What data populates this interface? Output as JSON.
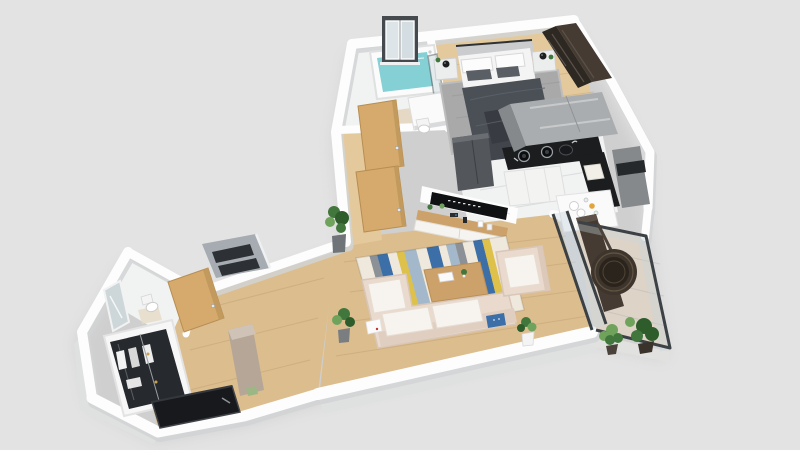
{
  "meta": {
    "view": "3d-isometric-apartment-floor-plan-render",
    "background": "#e3e3e3",
    "visible_text": ""
  },
  "palette": {
    "background": "#e3e3e3",
    "wall": "#fdfdfd",
    "wall_shade": "#d2d4d5",
    "wall_face": "#dfe0e0",
    "floor_wood": "#dcbd8e",
    "floor_wood_light": "#e4c99c",
    "floor_marble": "#f1f2f2",
    "floor_balcony": "#ddd3c6",
    "door_oak": "#d5aa6c",
    "door_oak_edge": "#b78d52",
    "rug_gray": "#a9a9a9",
    "rug_cream": "#efe9dd",
    "stripe_blue": "#3c6fa8",
    "stripe_lightblue": "#a3b9cb",
    "stripe_yellow": "#ddc14a",
    "stripe_gray": "#8b9196",
    "sofa_beige": "#e9dacd",
    "sofa_back": "#e0cfc1",
    "cushion_white": "#f7f3ee",
    "water_teal": "#84d0d5",
    "counter_black": "#1b1d1f",
    "cabinet_gray": "#aaadaf",
    "cabinet_gray_dark": "#85898c",
    "cabinet_white": "#f3f3f2",
    "fridge_gray": "#53575b",
    "dark_brown": "#453b33",
    "dark_brown_deep": "#2e2823",
    "wicker": "#3e352c",
    "wicker_dark": "#2a241d",
    "glass_frame": "#3c4145",
    "glass_tint": "#c9d8dd",
    "plant_green": "#41763c",
    "plant_green_dark": "#2e5c2b",
    "plant_green_light": "#6fa35c",
    "accent_orange": "#e2a43f",
    "entry_door_black": "#17191c",
    "tv_black": "#0f1113",
    "wood_console": "#cda26a",
    "greige": "#b5a697",
    "mirror_silver": "#cdd7da",
    "lamp_black": "#1c1e20"
  },
  "scene": {
    "rooms": [
      {
        "name": "bathroom",
        "items": [
          "casement-window",
          "bathtub",
          "teal-water",
          "shower-glass-screen",
          "vanity",
          "toilet"
        ]
      },
      {
        "name": "bedroom",
        "items": [
          "double-bed",
          "white-pillows",
          "gray-pillows",
          "dark-gray-blanket",
          "nightstand-left",
          "nightstand-right",
          "black-table-lamps",
          "gray-area-rug",
          "dark-brown-wardrobe"
        ]
      },
      {
        "name": "kitchen",
        "items": [
          "gray-upper-cabinets",
          "refrigerator",
          "black-l-counter",
          "gas-burners",
          "round-sink",
          "cutting-board",
          "white-base-cabinets",
          "tall-gray-cabinet",
          "oven-band",
          "dish-peninsula",
          "white-plates",
          "orange-cup"
        ]
      },
      {
        "name": "living-room",
        "items": [
          "wall-tv",
          "wood-media-console",
          "console-decor",
          "striped-rug",
          "coffee-table",
          "beige-corner-sofa",
          "seat-cushions",
          "blue-pillow",
          "white-pillow",
          "beige-armchair",
          "potted-plants",
          "sliding-glass-door"
        ]
      },
      {
        "name": "balcony",
        "items": [
          "glass-railing",
          "hanging-egg-chair",
          "leafy-plant",
          "fern-plant",
          "dark-brown-divider"
        ]
      },
      {
        "name": "hallway",
        "items": [
          "oak-door-upper",
          "oak-door-lower",
          "skylight-glass-box",
          "greige-cabinet"
        ]
      },
      {
        "name": "entry",
        "items": [
          "black-entrance-door",
          "glass-front-wardrobe",
          "hanging-clothes",
          "wc-room",
          "leaning-mirror",
          "wc-toilet",
          "oak-wc-door"
        ]
      }
    ]
  },
  "living_room_rug": {
    "corners": {
      "ax": 356,
      "ay": 258,
      "bx": 506,
      "by": 236,
      "cx": 524,
      "cy": 310,
      "dx": 378,
      "dy": 336
    },
    "stripes": [
      {
        "c": "rug_cream",
        "w": 0.09
      },
      {
        "c": "stripe_gray",
        "w": 0.05
      },
      {
        "c": "stripe_blue",
        "w": 0.07
      },
      {
        "c": "rug_cream",
        "w": 0.06
      },
      {
        "c": "stripe_yellow",
        "w": 0.05
      },
      {
        "c": "stripe_lightblue",
        "w": 0.08
      },
      {
        "c": "rug_cream",
        "w": 0.07
      },
      {
        "c": "stripe_blue",
        "w": 0.08
      },
      {
        "c": "rug_cream",
        "w": 0.05
      },
      {
        "c": "stripe_lightblue",
        "w": 0.06
      },
      {
        "c": "stripe_gray",
        "w": 0.05
      },
      {
        "c": "rug_cream",
        "w": 0.07
      },
      {
        "c": "stripe_blue",
        "w": 0.06
      },
      {
        "c": "stripe_yellow",
        "w": 0.05
      },
      {
        "c": "rug_cream",
        "w": 0.11
      }
    ]
  }
}
